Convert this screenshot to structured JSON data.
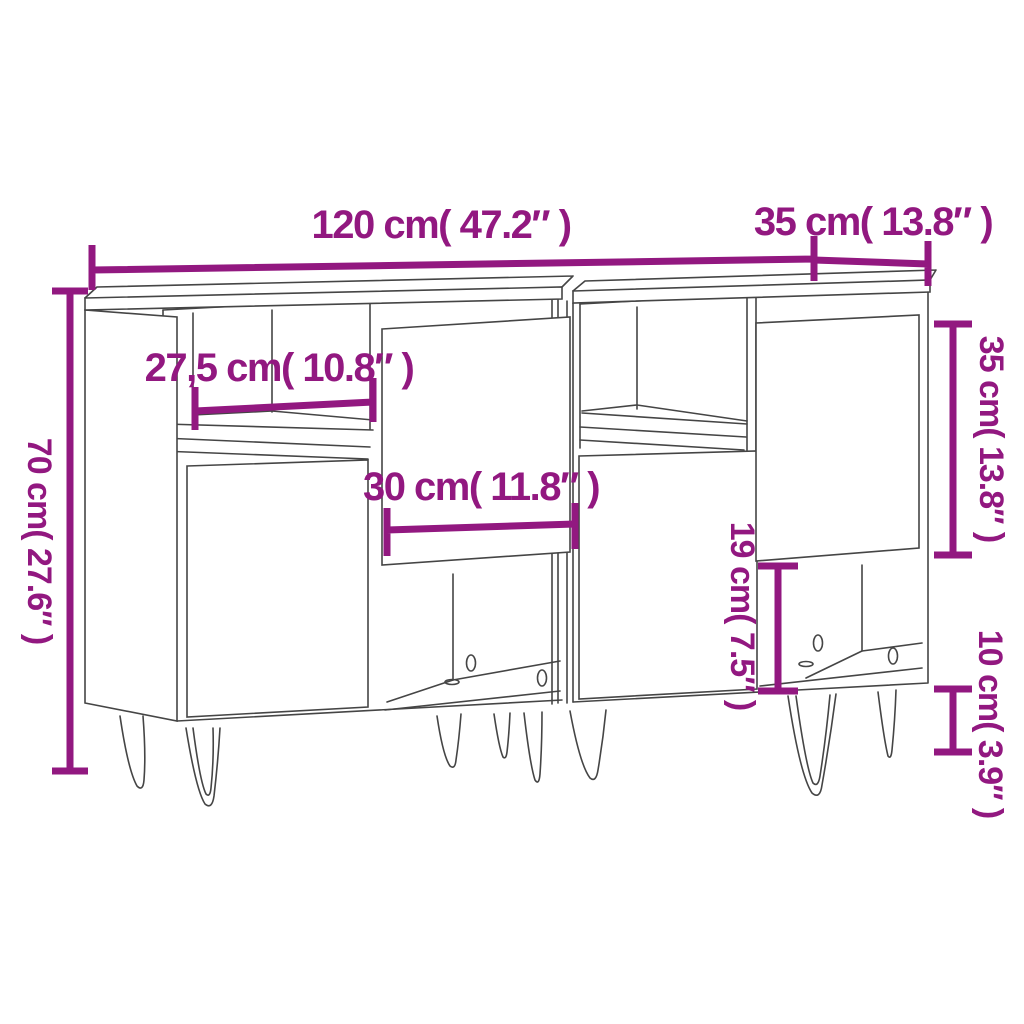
{
  "diagram": {
    "subject": "two sideboards with hairpin legs, line drawing with dimension annotations",
    "style": {
      "accent_color": "#921880",
      "line_color": "#454545",
      "background": "#FFFFFF"
    },
    "dimensions": [
      {
        "id": "total-width",
        "label": "120 cm( 47.2″ )",
        "cm": "120",
        "inches": "47.2",
        "orientation": "horizontal"
      },
      {
        "id": "top-depth",
        "label": "35 cm( 13.8″ )",
        "cm": "35",
        "inches": "13.8",
        "orientation": "horizontal"
      },
      {
        "id": "total-height",
        "label": "70 cm( 27.6″ )",
        "cm": "70",
        "inches": "27.6",
        "orientation": "vertical"
      },
      {
        "id": "shelf-width",
        "label": "27,5 cm( 10.8″ )",
        "cm": "27,5",
        "inches": "10.8",
        "orientation": "horizontal"
      },
      {
        "id": "door-width",
        "label": "30 cm( 11.8″ )",
        "cm": "30",
        "inches": "11.8",
        "orientation": "horizontal"
      },
      {
        "id": "door-height",
        "label": "35 cm( 13.8″ )",
        "cm": "35",
        "inches": "13.8",
        "orientation": "vertical"
      },
      {
        "id": "opening-height",
        "label": "19 cm( 7.5″ )",
        "cm": "19",
        "inches": "7.5",
        "orientation": "vertical"
      },
      {
        "id": "leg-height",
        "label": "10 cm( 3.9″ )",
        "cm": "10",
        "inches": "3.9",
        "orientation": "vertical"
      }
    ]
  }
}
